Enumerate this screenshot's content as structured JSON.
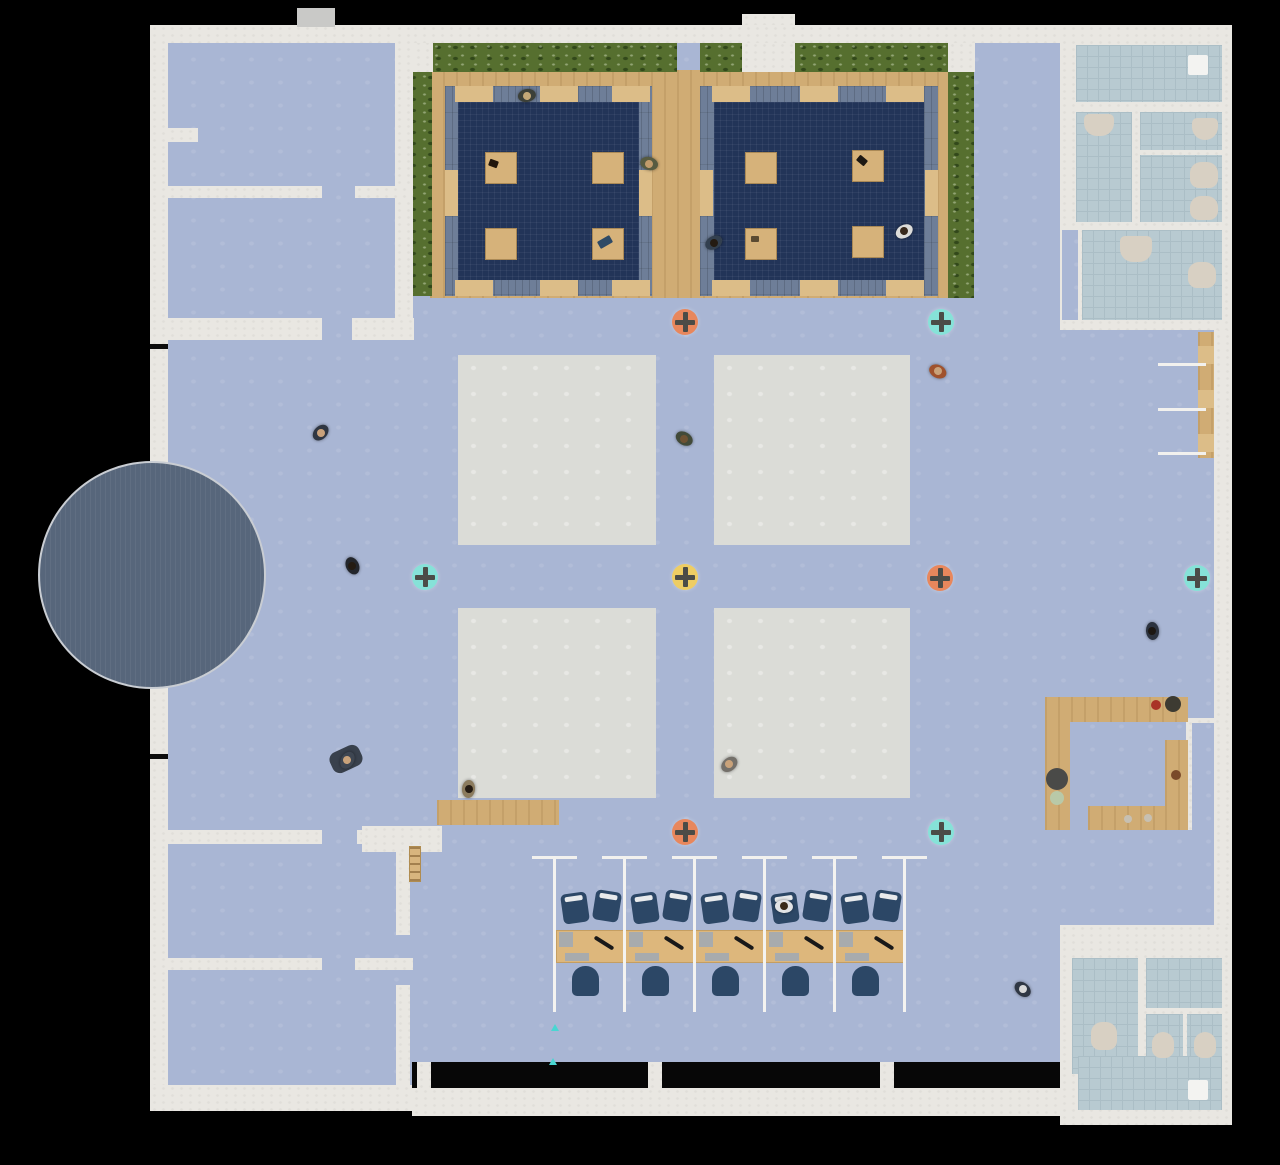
{
  "scene": {
    "type": "office-floorplan-simulation",
    "width": 1280,
    "height": 1165,
    "background": "#000000"
  },
  "palette": {
    "floor": "#a9b6d4",
    "wall": "#e9e7e2",
    "gray_zone": "#dbdcd7",
    "terrace_navy": "#223458",
    "terrace_panel": "#6e7e98",
    "hedge_green": "#566f2f",
    "wood": "#d0ac74",
    "tile": "#b8cad1",
    "fixture_beige": "#d8d0c3",
    "stage_circle": "#57667b",
    "chair_navy": "#2c4766",
    "marker_salmon": "#e8875c",
    "marker_teal": "#86e2d8",
    "marker_yellow": "#eecd63",
    "marker_plus": "#4b4c47"
  },
  "markers": [
    {
      "id": "m1",
      "color": "salmon",
      "x": 685,
      "y": 322
    },
    {
      "id": "m2",
      "color": "teal",
      "x": 941,
      "y": 322
    },
    {
      "id": "m3",
      "color": "teal",
      "x": 425,
      "y": 577
    },
    {
      "id": "m4",
      "color": "yellow",
      "x": 685,
      "y": 577
    },
    {
      "id": "m5",
      "color": "salmon",
      "x": 940,
      "y": 578
    },
    {
      "id": "m6",
      "color": "teal",
      "x": 1197,
      "y": 578
    },
    {
      "id": "m7",
      "color": "salmon",
      "x": 685,
      "y": 832
    },
    {
      "id": "m8",
      "color": "teal",
      "x": 941,
      "y": 832
    }
  ],
  "people": [
    {
      "x": 527,
      "y": 96,
      "rot": 170,
      "body": "#3c4038",
      "head": "#c4a877"
    },
    {
      "x": 649,
      "y": 164,
      "rot": 195,
      "body": "#575b41",
      "head": "#c19b6b"
    },
    {
      "x": 714,
      "y": 243,
      "rot": 150,
      "body": "#33404f",
      "head": "#241b12"
    },
    {
      "x": 904,
      "y": 231,
      "rot": 330,
      "body": "#dcdcda",
      "head": "#38291c"
    },
    {
      "x": 938,
      "y": 371,
      "rot": 25,
      "body": "#a0522d",
      "head": "#c9a27a"
    },
    {
      "x": 684,
      "y": 439,
      "rot": 210,
      "body": "#424a39",
      "head": "#6e5233"
    },
    {
      "x": 321,
      "y": 433,
      "rot": 135,
      "body": "#2f3642",
      "head": "#caa27b"
    },
    {
      "x": 352,
      "y": 566,
      "rot": 245,
      "body": "#23262c",
      "head": "#241b12"
    },
    {
      "x": 347,
      "y": 760,
      "rot": 300,
      "body": "#3e4652",
      "head": "#c9a27a"
    },
    {
      "x": 469,
      "y": 789,
      "rot": 95,
      "body": "#8c7c5e",
      "head": "#241b12"
    },
    {
      "x": 729,
      "y": 764,
      "rot": 320,
      "body": "#74706a",
      "head": "#c9a27a"
    },
    {
      "x": 784,
      "y": 906,
      "rot": 5,
      "body": "#e2e3e5",
      "head": "#3a2a19"
    },
    {
      "x": 1023,
      "y": 989,
      "rot": 40,
      "body": "#2f3744",
      "head": "#d9d9d9"
    },
    {
      "x": 1152,
      "y": 631,
      "rot": 265,
      "body": "#2c333f",
      "head": "#1c1712"
    }
  ],
  "terrace": {
    "tables": [
      {
        "x": 485,
        "y": 152
      },
      {
        "x": 592,
        "y": 152
      },
      {
        "x": 485,
        "y": 228
      },
      {
        "x": 592,
        "y": 228
      },
      {
        "x": 745,
        "y": 152
      },
      {
        "x": 852,
        "y": 150
      },
      {
        "x": 745,
        "y": 228
      },
      {
        "x": 852,
        "y": 226
      }
    ],
    "table_items": [
      {
        "x": 489,
        "y": 160,
        "w": 9,
        "h": 7,
        "rot": 20,
        "color": "#22160c"
      },
      {
        "x": 598,
        "y": 238,
        "w": 14,
        "h": 8,
        "rot": -30,
        "color": "#2e4a66"
      },
      {
        "x": 857,
        "y": 157,
        "w": 10,
        "h": 7,
        "rot": 40,
        "color": "#1d1812"
      },
      {
        "x": 751,
        "y": 236,
        "w": 8,
        "h": 6,
        "rot": 0,
        "color": "#5a4a32"
      }
    ]
  },
  "workstations": {
    "cubicle_count": 5,
    "partition_xs": [
      553,
      623,
      693,
      763,
      833,
      903
    ],
    "desk": {
      "x": 556,
      "y": 930,
      "w": 350,
      "h": 33
    }
  },
  "bath_fixtures": [
    {
      "x": 1188,
      "y": 55,
      "w": 20,
      "h": 20,
      "shape": "shower"
    },
    {
      "x": 1084,
      "y": 114,
      "w": 30,
      "h": 22,
      "shape": "sink"
    },
    {
      "x": 1192,
      "y": 118,
      "w": 26,
      "h": 22,
      "shape": "sink"
    },
    {
      "x": 1190,
      "y": 162,
      "w": 28,
      "h": 26,
      "shape": "toilet"
    },
    {
      "x": 1190,
      "y": 196,
      "w": 28,
      "h": 24,
      "shape": "toilet"
    },
    {
      "x": 1120,
      "y": 236,
      "w": 32,
      "h": 26,
      "shape": "sink"
    },
    {
      "x": 1188,
      "y": 262,
      "w": 28,
      "h": 26,
      "shape": "toilet"
    },
    {
      "x": 1091,
      "y": 1022,
      "w": 26,
      "h": 28,
      "shape": "toilet"
    },
    {
      "x": 1152,
      "y": 1032,
      "w": 22,
      "h": 26,
      "shape": "toilet"
    },
    {
      "x": 1194,
      "y": 1032,
      "w": 22,
      "h": 26,
      "shape": "toilet"
    },
    {
      "x": 1188,
      "y": 1080,
      "w": 20,
      "h": 20,
      "shape": "shower"
    }
  ],
  "kitchen_appliances": [
    {
      "cx": 1156,
      "cy": 705,
      "r": 5,
      "color": "#a93226",
      "name": "hot-plate"
    },
    {
      "cx": 1173,
      "cy": 704,
      "r": 8,
      "color": "#3d3b32",
      "name": "pot"
    },
    {
      "cx": 1057,
      "cy": 779,
      "r": 11,
      "color": "#4a4a48",
      "name": "sink-basin"
    },
    {
      "cx": 1057,
      "cy": 798,
      "r": 7,
      "color": "#b9c9a8",
      "name": "bowl"
    },
    {
      "cx": 1176,
      "cy": 775,
      "r": 5,
      "color": "#7a4a2a",
      "name": "knob"
    },
    {
      "cx": 1128,
      "cy": 819,
      "r": 4,
      "color": "#c7c0b2",
      "name": "tap"
    },
    {
      "cx": 1148,
      "cy": 818,
      "r": 4,
      "color": "#c7c0b2",
      "name": "tap"
    }
  ],
  "misc": {
    "mat": {
      "x": 330,
      "y": 748,
      "w": 32,
      "h": 22,
      "rot": -25,
      "color": "#39414d"
    },
    "cyan_arrows": [
      {
        "x": 551,
        "y": 1024
      },
      {
        "x": 549,
        "y": 1058
      }
    ]
  }
}
